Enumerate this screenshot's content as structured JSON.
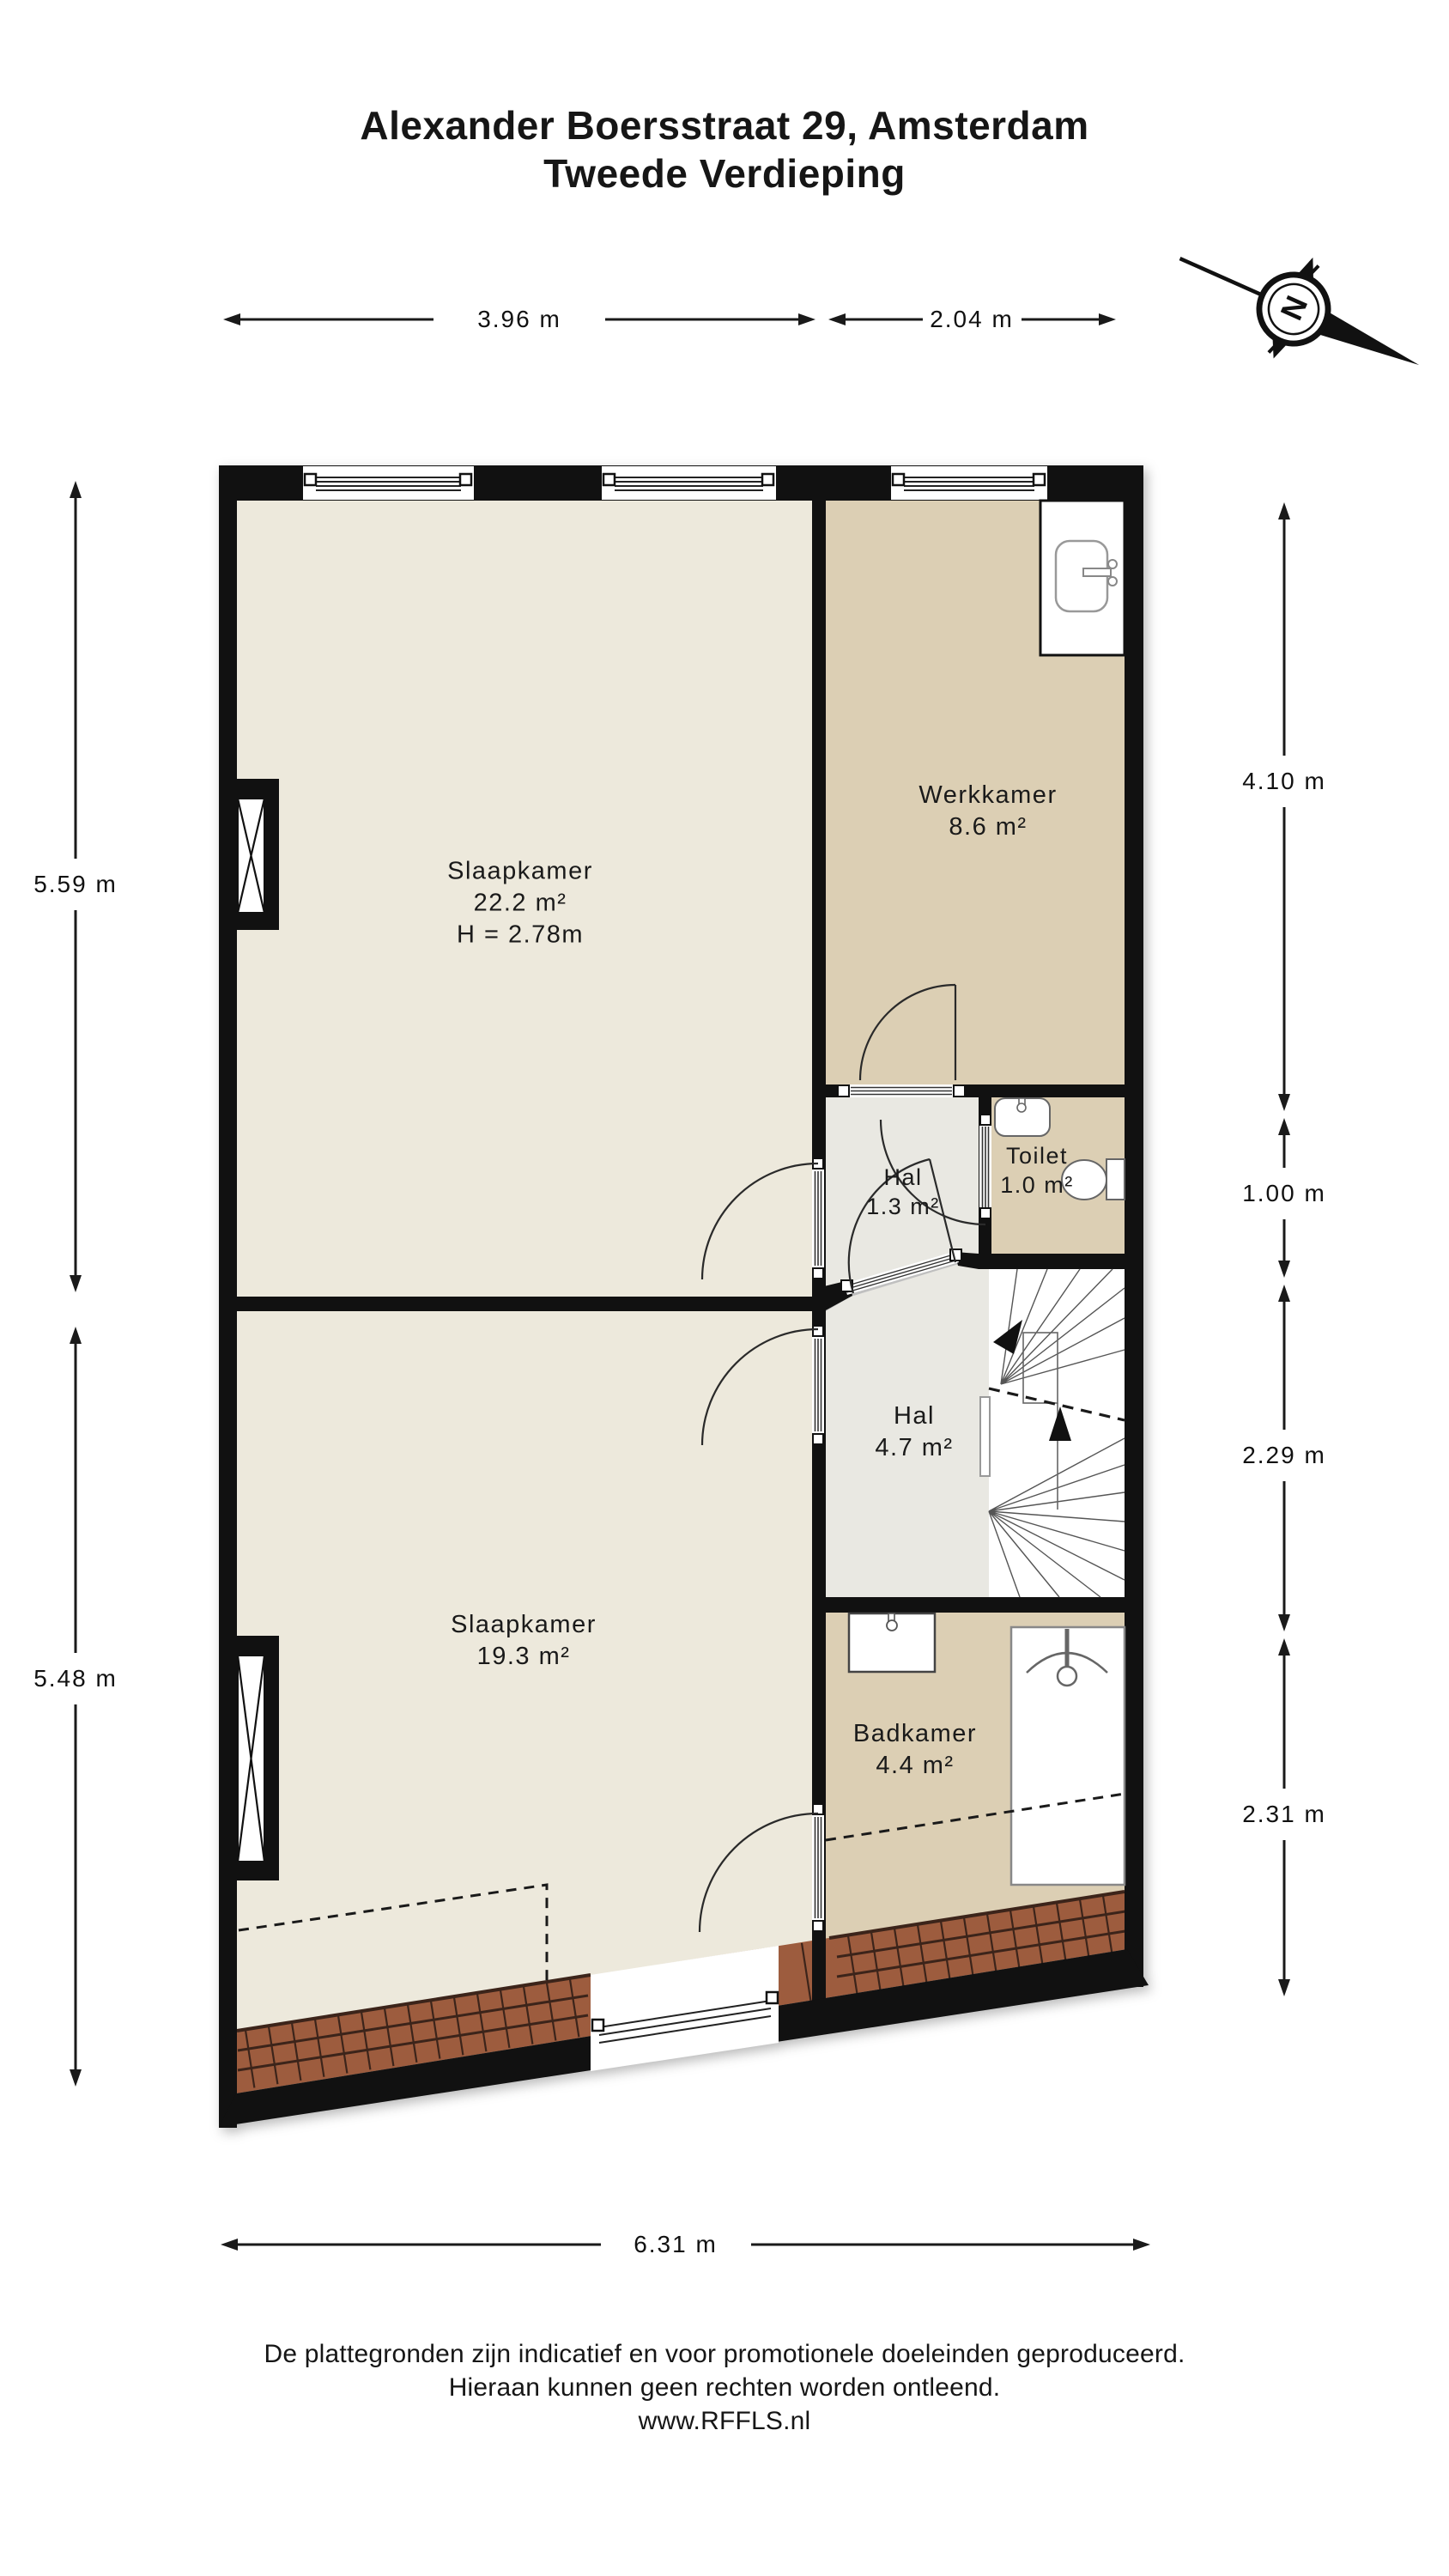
{
  "title": {
    "line1": "Alexander Boersstraat 29, Amsterdam",
    "line2": "Tweede Verdieping"
  },
  "compass": {
    "label": "N"
  },
  "dimensions": {
    "top_left": "3.96 m",
    "top_right": "2.04 m",
    "left_upper": "5.59 m",
    "left_lower": "5.48 m",
    "right_1": "4.10 m",
    "right_2": "1.00 m",
    "right_3": "2.29 m",
    "right_4": "2.31 m",
    "bottom": "6.31 m"
  },
  "rooms": {
    "slaapkamer_1": {
      "name": "Slaapkamer",
      "area": "22.2 m²",
      "ceiling_height": "H = 2.78m"
    },
    "werkkamer": {
      "name": "Werkkamer",
      "area": "8.6 m²"
    },
    "hal_1": {
      "name": "Hal",
      "area": "1.3 m²"
    },
    "toilet": {
      "name": "Toilet",
      "area": "1.0 m²"
    },
    "hal_2": {
      "name": "Hal",
      "area": "4.7 m²"
    },
    "slaapkamer_2": {
      "name": "Slaapkamer",
      "area": "19.3 m²"
    },
    "badkamer": {
      "name": "Badkamer",
      "area": "4.4 m²"
    }
  },
  "footer": {
    "line1": "De plattegronden zijn indicatief en voor promotionele doeleinden geproduceerd.",
    "line2": "Hieraan kunnen geen rechten worden ontleend.",
    "line3": "www.RFFLS.nl"
  },
  "colors": {
    "wall": "#111111",
    "floor_bedroom": "#EDE9DC",
    "floor_work_bath": "#DCCFB4",
    "floor_hall": "#E9E8E2",
    "roof_tile": "#9D5C3E",
    "roof_tile_line": "#3C241A"
  }
}
